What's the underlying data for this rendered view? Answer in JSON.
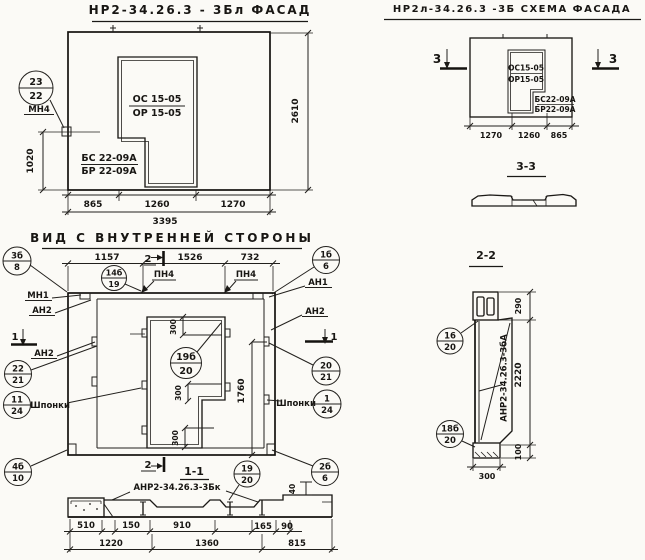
{
  "titles": {
    "facade": "НР2-34.26.3 - 3Бл ФАСАД",
    "schema": "НР2л-34.26.3 -3Б СХЕМА ФАСАДА",
    "inner_view": "ВИД С ВНУТРЕННЕЙ СТОРОНЫ",
    "section_33": "3-3",
    "section_11": "1-1",
    "section_22": "2-2"
  },
  "marks": {
    "mn1": "МН1",
    "mn4": "МН4",
    "an1": "АН1",
    "an2": "АН2",
    "pn4": "ПН4",
    "shponki": "Шпонки",
    "sec1": "1",
    "sec2": "2",
    "sec3": "3"
  },
  "facade": {
    "os": "ОС 15-05",
    "or_": "ОР 15-05",
    "bs": "БС 22-09А",
    "br": "БР 22-09А",
    "d865": "865",
    "d1260": "1260",
    "d1270": "1270",
    "d3395": "3395",
    "d1020": "1020",
    "d2610": "2610",
    "callout": {
      "a": "23",
      "b": "22"
    }
  },
  "schema": {
    "os": "ОС15-05",
    "or_": "ОР15-05",
    "bs": "БС22-09А",
    "br": "БР22-09А",
    "d1270": "1270",
    "d1260": "1260",
    "d865": "865"
  },
  "inner": {
    "d1157": "1157",
    "d1526": "1526",
    "d732": "732",
    "d300": "300",
    "d1760": "1760",
    "callouts": {
      "c3b8": {
        "a": "3б",
        "b": "8"
      },
      "c14b19": {
        "a": "14б",
        "b": "19"
      },
      "c1b6": {
        "a": "1б",
        "b": "6"
      },
      "c2221": {
        "a": "22",
        "b": "21"
      },
      "c1124": {
        "a": "11",
        "b": "24"
      },
      "c2021": {
        "a": "20",
        "b": "21"
      },
      "c124": {
        "a": "1",
        "b": "24"
      },
      "c19b20": {
        "a": "19б",
        "b": "20"
      },
      "c4b10": {
        "a": "4б",
        "b": "10"
      },
      "c2b6": {
        "a": "2б",
        "b": "6"
      }
    }
  },
  "s11": {
    "label": "АНР2-34.26.3-3Бк",
    "d510": "510",
    "d150": "150",
    "d910": "910",
    "d165": "165",
    "d90": "90",
    "d1220": "1220",
    "d1360": "1360",
    "d815": "815",
    "d40": "40",
    "callout": {
      "a": "19",
      "b": "20"
    }
  },
  "s22": {
    "label": "АНР2-34.26.3-3бА",
    "d290": "290",
    "d2220": "2220",
    "d100": "100",
    "d300": "300",
    "callouts": {
      "c1620": {
        "a": "16",
        "b": "20"
      },
      "c18b20": {
        "a": "18б",
        "b": "20"
      }
    }
  }
}
